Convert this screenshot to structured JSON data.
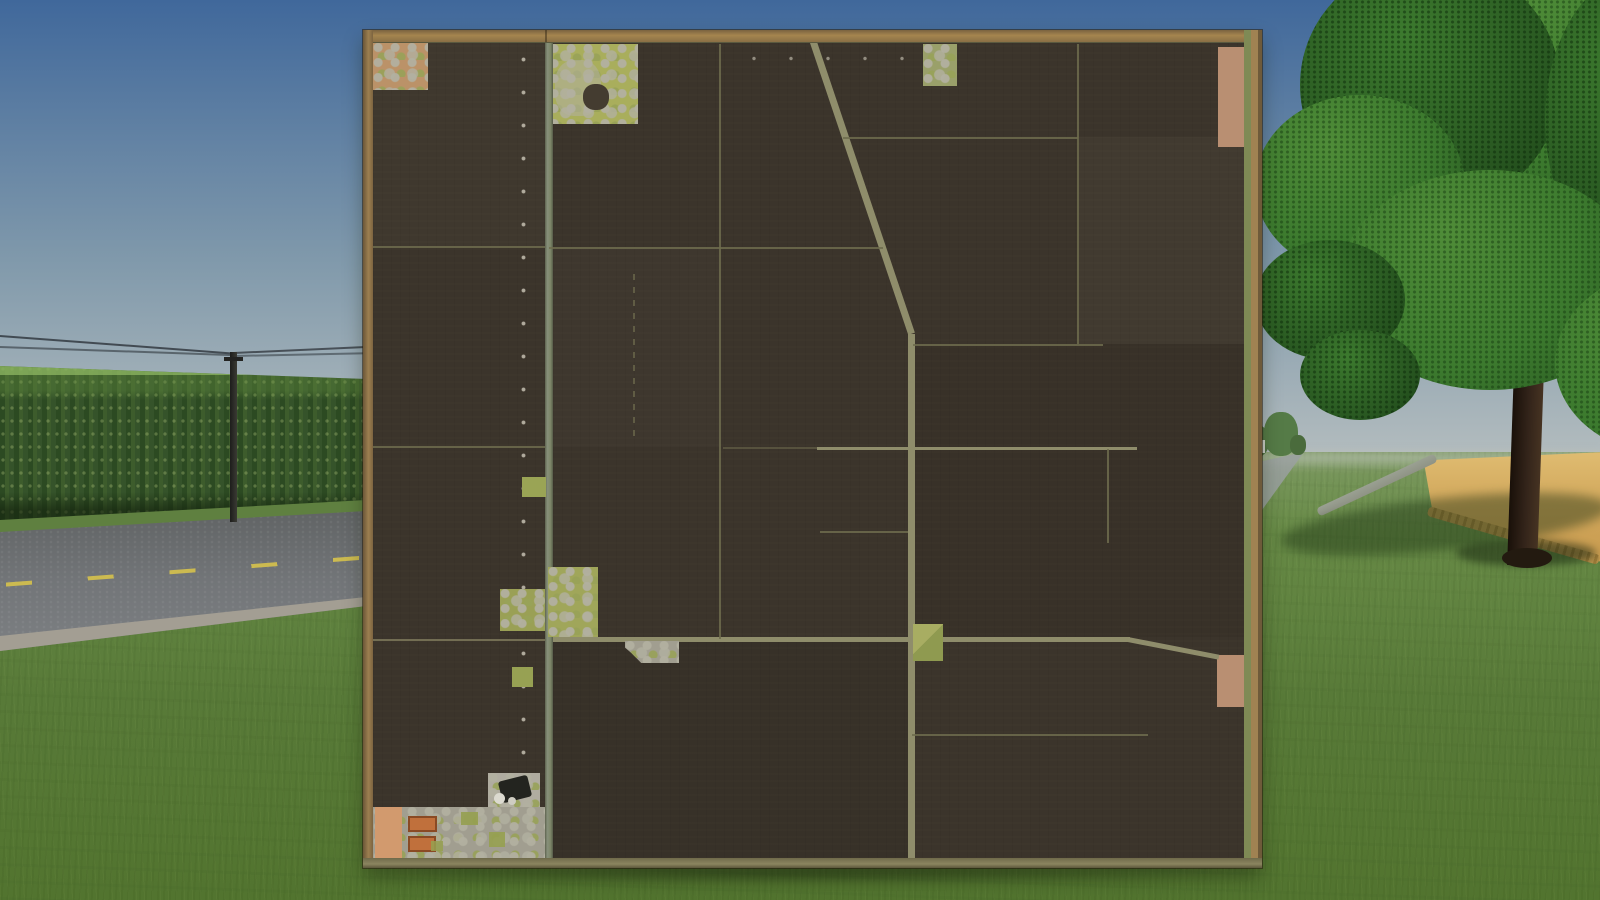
{
  "scene": {
    "label": "wooden field-map overview board in farm landscape"
  },
  "icons": {
    "vehicle_marker": "tractor-icon",
    "streetlight_markers": "dot-markers",
    "farm_buildings": "orange-roof-rectangles",
    "pond_marker": "dark-pond-blob"
  },
  "colors": {
    "sky_top": "#40689b",
    "sky_mid": "#8099ab",
    "sky_horizon": "#b7bfc0",
    "corn_dark": "#2c4a22",
    "corn_mid": "#3d5c2c",
    "verge_green": "#5f8040",
    "asphalt": "#727578",
    "asphalt_dark": "#5f6263",
    "shoulder": "#a39e93",
    "road_marking": "#d6c24c",
    "wire": "#262b31",
    "grass_far": "#7d9a62",
    "grass_mid": "#678a46",
    "grass_near": "#587a38",
    "wheat": "#d2a85c",
    "wheat_edge": "#b5904a",
    "ditch": "#8f9385",
    "dist_tree": "#557b47",
    "dist_building": "#ccd0c8",
    "foliage": "#3c7a2e",
    "foliage_light": "#4f8c38",
    "foliage_dark": "#2a5a22",
    "trunk_dark": "#191009",
    "trunk_light": "#463322",
    "frame_wood": "#a5854f",
    "frame_wood_dark": "#6b5638",
    "frame_olive": "#7f8a55",
    "map_field": "#3b342b",
    "map_line": "#6f6c4e",
    "map_road": "#8f8d6b",
    "patch_tan": "#bb9268",
    "patch_tan2": "#b98f72",
    "farmstead_green": "#a9ae5c",
    "mottle_gray": "#b2b0a0",
    "pond": "#443c30",
    "peach": "#d29a6e",
    "roof_orange": "#c0703c",
    "concrete": "#a19e90",
    "marker_dot": "#cdc8b9",
    "vehicle_dark": "#23241f"
  }
}
